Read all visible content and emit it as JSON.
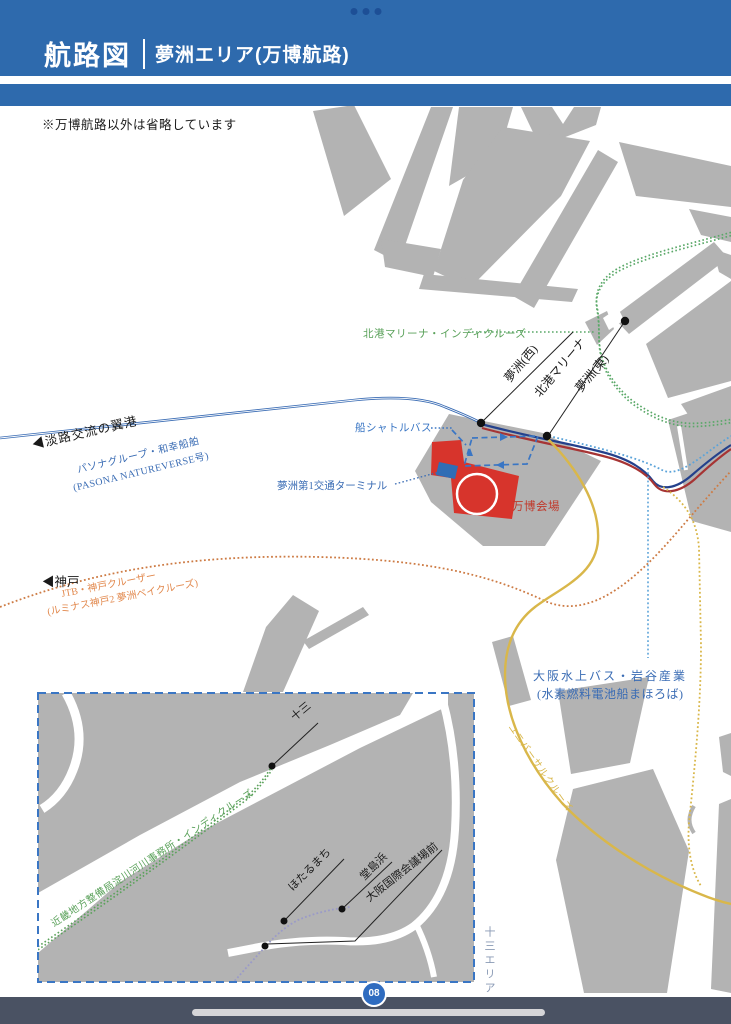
{
  "header": {
    "title": "航路図",
    "subtitle": "夢洲エリア(万博航路)"
  },
  "map": {
    "note": "※万博航路以外は省略しています",
    "labels": {
      "hokko_cruise": "北港マリーナ・インディクルーズ",
      "yumeshima_west": "夢洲(西)",
      "hokko_marina": "北港マリーナ",
      "yumeshima_east": "夢洲(東)",
      "boat_shuttle": "船シャトルバス",
      "awaji_port": "◀淡路交流の翼港",
      "pasona_1": "パソナグループ・和幸船舶",
      "pasona_2": "(PASONA NATUREVERSE号)",
      "terminal": "夢洲第1交通ターミナル",
      "expo_venue": "万博会場",
      "kobe": "◀神戸",
      "jtb_1": "JTB・神戸クルーザー",
      "jtb_2": "(ルミナス神戸2 夢洲ベイクルーズ)",
      "suijo_1": "大阪水上バス・岩谷産業",
      "suijo_2": "(水素燃料電池船まほろば)",
      "universal": "ユニバーサルクルーズ"
    },
    "inset": {
      "route": "近畿地方整備局淀川河川事務所・インディクルーズ",
      "juso": "十三",
      "hotarumachi": "ほたるまち",
      "dojimahama": "堂島浜",
      "kokusaikaigijo": "大阪国際会議場前",
      "area_label": "十三エリア"
    },
    "colors": {
      "header_blue": "#2e6aad",
      "header_dot": "#1d4f96",
      "land_gray": "#b3b3b3",
      "venue_red": "#d7342c",
      "terminal_blue": "#2f6db5",
      "route_navy": "#24418c",
      "route_darkred": "#a63434",
      "route_blue": "#3a6cb4",
      "route_lightblue": "#5ba3d9",
      "route_green": "#5aa868",
      "route_orange": "#cd7b44",
      "route_yellow": "#d9b74a",
      "shuttle_blue": "#3a76c4",
      "inset_border_blue": "#3a76c4",
      "inset_route_purple": "#9a9ac8",
      "label_green": "#5aa15a",
      "label_orange": "#e2894e",
      "label_blue": "#3a6cb4",
      "label_red": "#c0392b",
      "area_label_gray": "#8a9ab5",
      "footer_bar": "#4a5263",
      "badge_blue": "#2f6cc0"
    }
  },
  "footer": {
    "page_number": "08"
  }
}
